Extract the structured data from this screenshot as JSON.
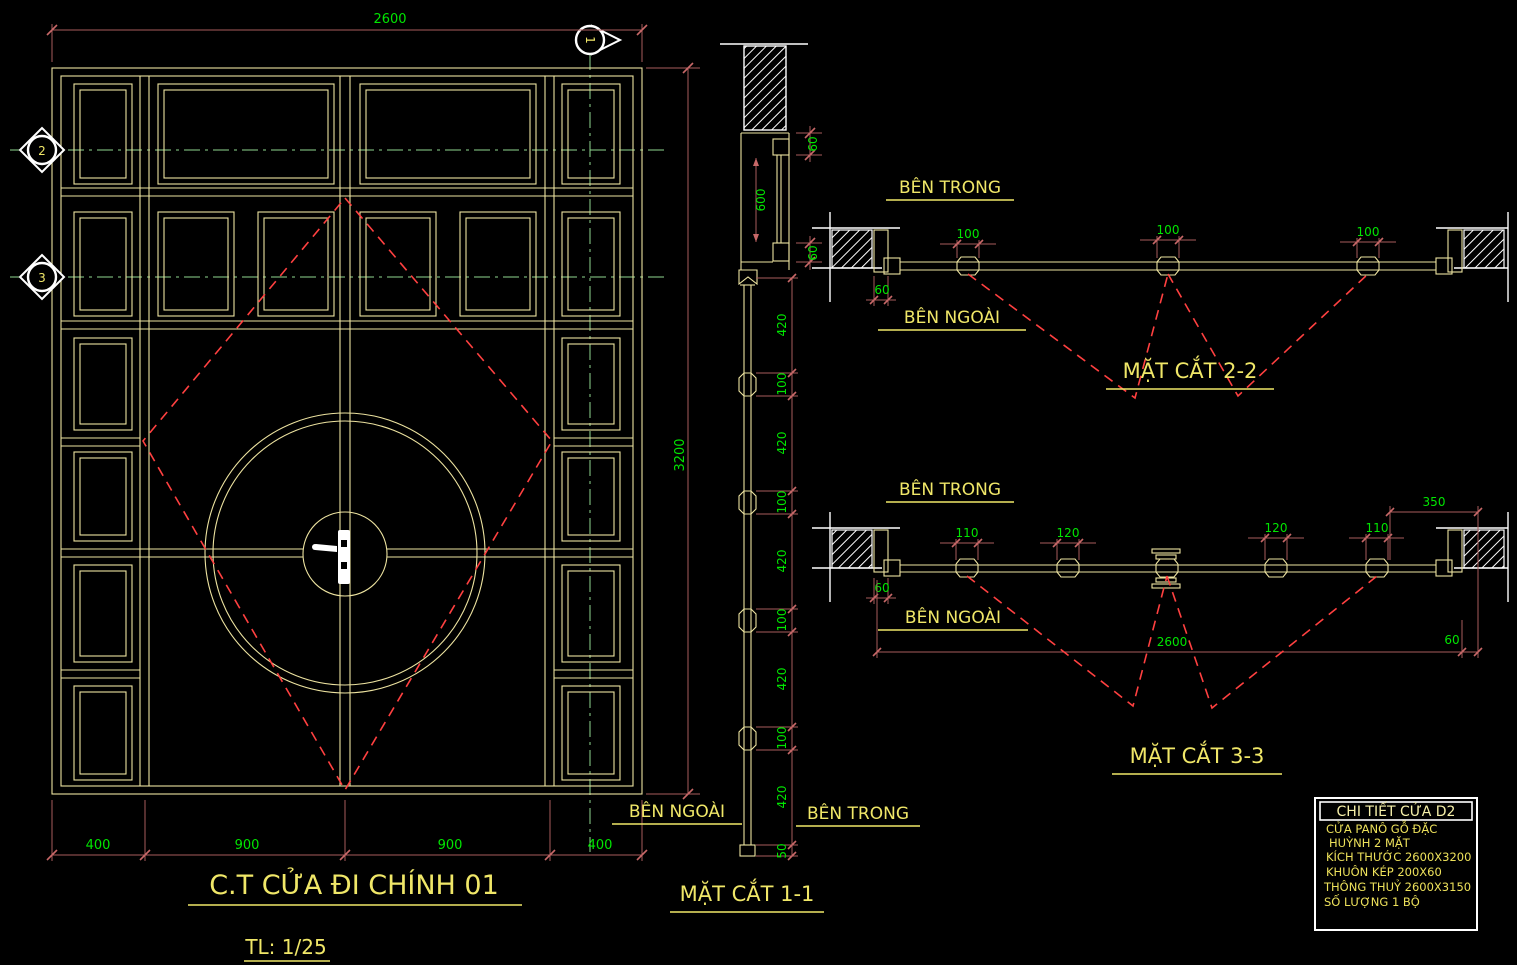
{
  "elevation": {
    "title": "C.T CỬA ĐI CHÍNH 01",
    "scale_label": "TL: 1/25",
    "dim_width_top": "2600",
    "dim_height_right": "3200",
    "dims_bottom": [
      "400",
      "900",
      "900",
      "400"
    ],
    "marker_1": "1",
    "marker_2": "2",
    "marker_3": "3"
  },
  "section_1_1": {
    "title": "MẶT CẮT 1-1",
    "label_outside": "BÊN NGOÀI",
    "label_inside": "BÊN TRONG",
    "dim_frame_top": "60",
    "dim_glass": "600",
    "dim_frame_bottom": "60",
    "dim_chain": [
      "420",
      "100",
      "420",
      "100",
      "420",
      "100",
      "420",
      "100",
      "420",
      "50"
    ]
  },
  "section_2_2": {
    "title": "MẶT CẮT 2-2",
    "label_inside": "BÊN TRONG",
    "label_outside": "BÊN NGOÀI",
    "dims_joint": [
      "100",
      "100",
      "100"
    ],
    "dim_frame": "60"
  },
  "section_3_3": {
    "title": "MẶT CẮT 3-3",
    "label_inside": "BÊN TRONG",
    "label_outside": "BÊN NGOÀI",
    "dims_joint": [
      "110",
      "120",
      "120",
      "110"
    ],
    "dim_right_panel": "350",
    "dim_total": "2600",
    "dim_frame_left": "60",
    "dim_frame_right": "60"
  },
  "title_block": {
    "header": "CHI TIẾT CỬA D2",
    "rows": [
      "CỬA PANÔ GỖ ĐẶC",
      "HUỲNH 2 MẶT",
      "KÍCH THƯỚC 2600X3200",
      "KHUÔN KÉP 200X60",
      "THÔNG THUỶ 2600X3150",
      "SỐ LƯỢNG 1 BỘ"
    ]
  },
  "colors": {
    "background": "#000000",
    "line_yellow": "#EDE3A0",
    "text_yellow": "#F0E768",
    "dim_green": "#00E600",
    "dim_line": "#A85B5B",
    "axis_green": "#8FD98F",
    "dash_red": "#FF4040",
    "white": "#FFFFFF"
  }
}
